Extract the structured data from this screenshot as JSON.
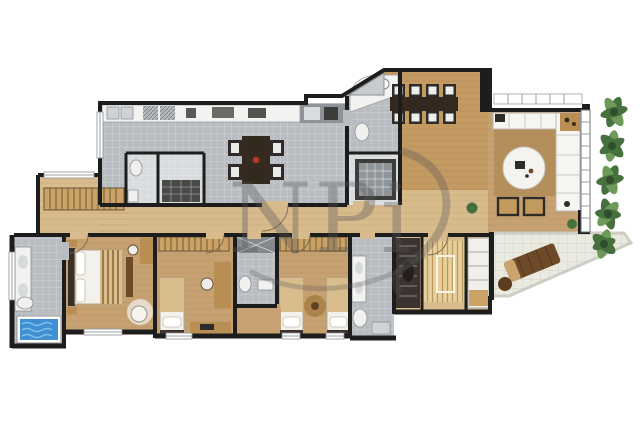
{
  "watermark": {
    "text": "NPi"
  },
  "palette": {
    "wall": "#1d1d1d",
    "wood_floor": "#c7a172",
    "wood_floor_light": "#d8bb8c",
    "wood_dining": "#c49a63",
    "tile_gray": "#b9bdc2",
    "tile_light": "#d9dcde",
    "terrace_tile": "#ebeae1",
    "counter_white": "#f2f2f0",
    "furniture_dark": "#2e2b29",
    "table_brown": "#33291f",
    "rug_brown": "#b08c57",
    "sofa_white": "#f6f5f2",
    "tub_blue": "#3f8fd2",
    "tub_blue_light": "#7fc0ea",
    "plant_green": "#46713f",
    "plant_green_light": "#6d9a58",
    "sauna_wood": "#e7cf9b",
    "lounge_brown": "#6f4a28",
    "accent_red": "#b23527",
    "watermark_gray": "#555555"
  },
  "floorplan": {
    "regions": [
      "kitchen",
      "pantry",
      "powder-room",
      "service-bathroom",
      "dining-room",
      "living-room",
      "balcony-garden",
      "terrace",
      "corridor",
      "hall",
      "master-bedroom",
      "master-bathroom",
      "bedroom-2",
      "bedroom-3",
      "shared-bathroom",
      "spa-bathroom",
      "spa-closet",
      "sauna",
      "shelf-unit"
    ]
  }
}
